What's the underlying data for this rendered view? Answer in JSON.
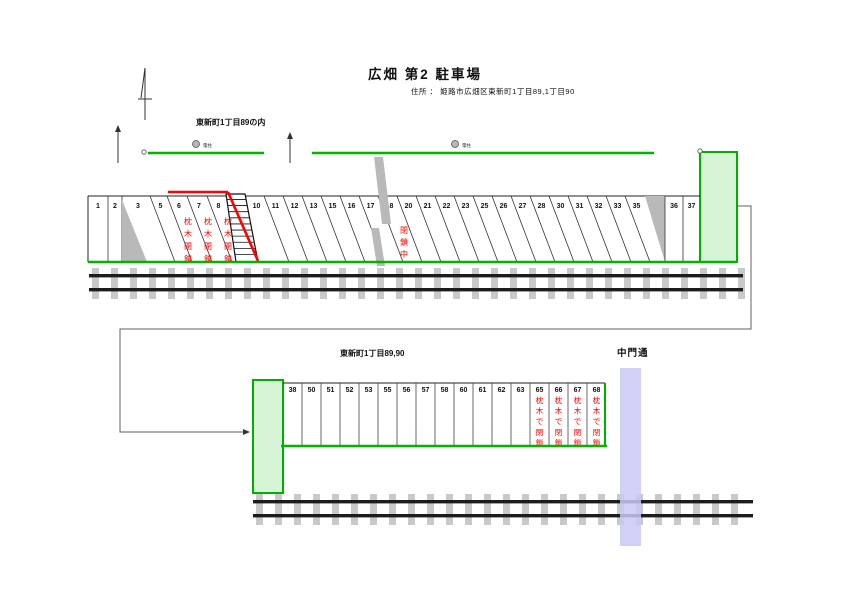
{
  "title": "広畑 第2 駐車場",
  "subtitle": "住所 ： 姫路市広畑区東新町1丁目89,1丁目90",
  "labels": {
    "upper_street": "東新町1丁目89の内",
    "lower_street": "東新町1丁目89,90",
    "cross_street": "中門通",
    "utility_pole": "電柱"
  },
  "upper_row": {
    "spaces": [
      "1",
      "2",
      "3",
      "5",
      "6",
      "7",
      "8",
      "10",
      "11",
      "12",
      "13",
      "15",
      "16",
      "17",
      "18",
      "20",
      "21",
      "22",
      "23",
      "25",
      "26",
      "27",
      "28",
      "30",
      "31",
      "32",
      "33",
      "35",
      "36",
      "37"
    ],
    "sleeper_closed": {
      "spaces": [
        "6",
        "7",
        "8"
      ],
      "label": "枕木閉鎖"
    },
    "barrier_after_space": "8",
    "closed_now": {
      "label": "閉鎖中",
      "near_space": "20"
    }
  },
  "lower_row": {
    "spaces": [
      "38",
      "50",
      "51",
      "52",
      "53",
      "55",
      "56",
      "57",
      "58",
      "60",
      "61",
      "62",
      "63",
      "65",
      "66",
      "67",
      "68"
    ],
    "sleeper_closed": {
      "spaces": [
        "65",
        "66",
        "67",
        "68"
      ],
      "label": "枕木で閉鎖"
    }
  },
  "colors": {
    "road_green": "#00b400",
    "area_fill": "#d6f5d6",
    "area_border": "#00b000",
    "closed_red": "#ff0000",
    "gray": "#b9b9b9",
    "sleeper_gray": "#c9c9c9",
    "rail_black": "#1c1c1c",
    "street_band": "#c9c9f7",
    "connector": "#606060",
    "text": "#111111"
  }
}
